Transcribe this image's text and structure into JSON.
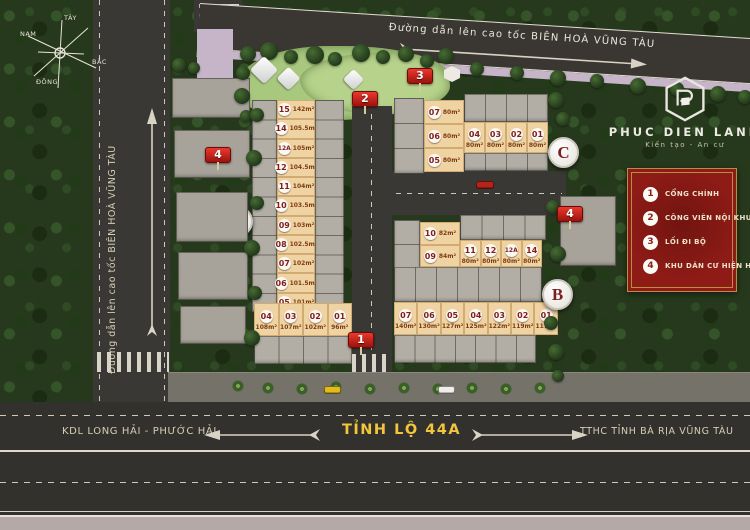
{
  "compass": {
    "north": "BẮC",
    "south": "NAM",
    "east": "ĐÔNG",
    "west": "TÂY"
  },
  "roads": {
    "top_label": "Đường dẫn lên cao tốc BIÊN HOÀ VŨNG TÀU",
    "left_label": "Đường dẫn lên cao tốc BIÊN HOÀ VŨNG TÀU",
    "bottom_name": "TỈNH LỘ 44A",
    "bottom_west": "KDL LONG HẢI - PHƯỚC HẢI",
    "bottom_east": "TTHC TỈNH BÀ RỊA VŨNG TÀU"
  },
  "branding": {
    "name": "PHUC DIEN LAND",
    "tagline": "Kiến tạo  -  An cư"
  },
  "legend": {
    "items": [
      {
        "num": "1",
        "label": "CỔNG CHÍNH"
      },
      {
        "num": "2",
        "label": "CÔNG VIÊN NỘI KHU"
      },
      {
        "num": "3",
        "label": "LỐI ĐI BỘ"
      },
      {
        "num": "4",
        "label": "KHU DÂN CƯ HIỆN HỮU"
      }
    ]
  },
  "markers": {
    "gate": "1",
    "park": "2",
    "walkway": "3",
    "existing_left": "4",
    "existing_right": "4"
  },
  "blocks": {
    "A": {
      "label": "A",
      "column_lots": [
        {
          "num": "15",
          "area": "142m²"
        },
        {
          "num": "14",
          "area": "105.5m²"
        },
        {
          "num": "12A",
          "area": "105m²"
        },
        {
          "num": "12",
          "area": "104.5m²"
        },
        {
          "num": "11",
          "area": "104m²"
        },
        {
          "num": "10",
          "area": "103.5m²"
        },
        {
          "num": "09",
          "area": "103m²"
        },
        {
          "num": "08",
          "area": "102.5m²"
        },
        {
          "num": "07",
          "area": "102m²"
        },
        {
          "num": "06",
          "area": "101.5m²"
        },
        {
          "num": "05",
          "area": "101m²"
        }
      ],
      "row_lots": [
        {
          "num": "04",
          "area": "108m²"
        },
        {
          "num": "03",
          "area": "107m²"
        },
        {
          "num": "02",
          "area": "102m²"
        },
        {
          "num": "01",
          "area": "96m²"
        }
      ]
    },
    "B": {
      "label": "B",
      "column_lots": [
        {
          "num": "10",
          "area": "82m²"
        },
        {
          "num": "09",
          "area": "84m²"
        },
        {
          "num": "08",
          "area": "86m²"
        }
      ],
      "mid_lots": [
        {
          "num": "11",
          "area": "80m²"
        },
        {
          "num": "12",
          "area": "80m²"
        },
        {
          "num": "12A",
          "area": "80m²"
        },
        {
          "num": "14",
          "area": "80m²"
        }
      ],
      "row_lots": [
        {
          "num": "07",
          "area": "140m²"
        },
        {
          "num": "06",
          "area": "130m²"
        },
        {
          "num": "05",
          "area": "127m²"
        },
        {
          "num": "04",
          "area": "125m²"
        },
        {
          "num": "03",
          "area": "122m²"
        },
        {
          "num": "02",
          "area": "119m²"
        },
        {
          "num": "01",
          "area": "117m²"
        }
      ]
    },
    "C": {
      "label": "C",
      "column_lots": [
        {
          "num": "07",
          "area": "80m²"
        },
        {
          "num": "06",
          "area": "80m²"
        },
        {
          "num": "05",
          "area": "80m²"
        }
      ],
      "row_lots": [
        {
          "num": "04",
          "area": "80m²"
        },
        {
          "num": "03",
          "area": "80m²"
        },
        {
          "num": "02",
          "area": "80m²"
        },
        {
          "num": "01",
          "area": "80m²"
        }
      ]
    }
  },
  "colors": {
    "legend_red": "#8e1b16",
    "lot_beige": "#f0d3a2",
    "lot_number_red": "#7e1f1f",
    "road_dark": "#3a3834",
    "highway_label_yellow": "#f2c53d",
    "sidewalk_lavender": "#c6b4c8"
  }
}
